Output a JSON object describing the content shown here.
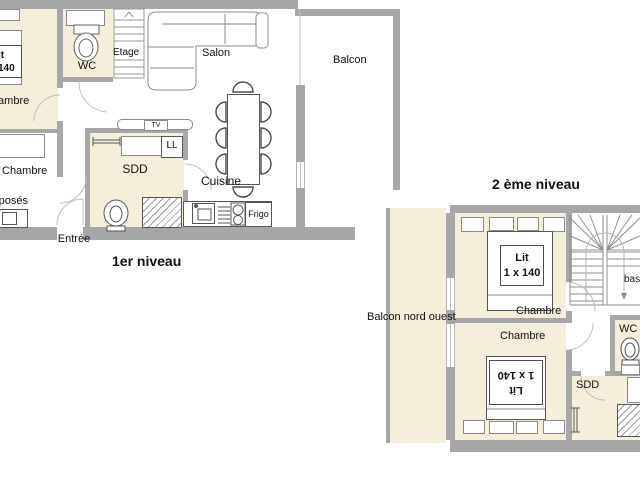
{
  "colors": {
    "room_fill": "#f5eedb",
    "wall": "#a7a7a7",
    "line_dark": "#555555",
    "line_mid": "#8a8a8a",
    "text": "#111111"
  },
  "level1": {
    "title": "1er niveau",
    "rooms": {
      "chambre_top": {
        "label": "Chambre",
        "bed": {
          "line1": "Lit",
          "line2": "1 x 140"
        }
      },
      "chambre_mid": {
        "label": "Chambre",
        "bunk_label": "superposés"
      },
      "wc": {
        "label": "WC"
      },
      "etage": {
        "label": "Etage"
      },
      "salon": {
        "label": "Salon"
      },
      "balcon": {
        "label": "Balcon"
      },
      "sdd": {
        "label": "SDD",
        "washer": "LL",
        "tv": "TV"
      },
      "cuisine": {
        "label": "Cuisine",
        "fridge": "Frigo"
      },
      "entree": {
        "label": "Entrée"
      }
    }
  },
  "level2": {
    "title": "2 ème niveau",
    "rooms": {
      "balcon": {
        "label": "Balcon nord ouest"
      },
      "chambre_top": {
        "label": "Chambre",
        "bed": {
          "line1": "Lit",
          "line2": "1 x 140"
        }
      },
      "chambre_bottom": {
        "label": "Chambre",
        "bed": {
          "line1": "Lit",
          "line2": "1 x 140"
        }
      },
      "stairs": {
        "label": "bas"
      },
      "wc": {
        "label": "WC"
      },
      "sdd": {
        "label": "SDD"
      }
    }
  }
}
